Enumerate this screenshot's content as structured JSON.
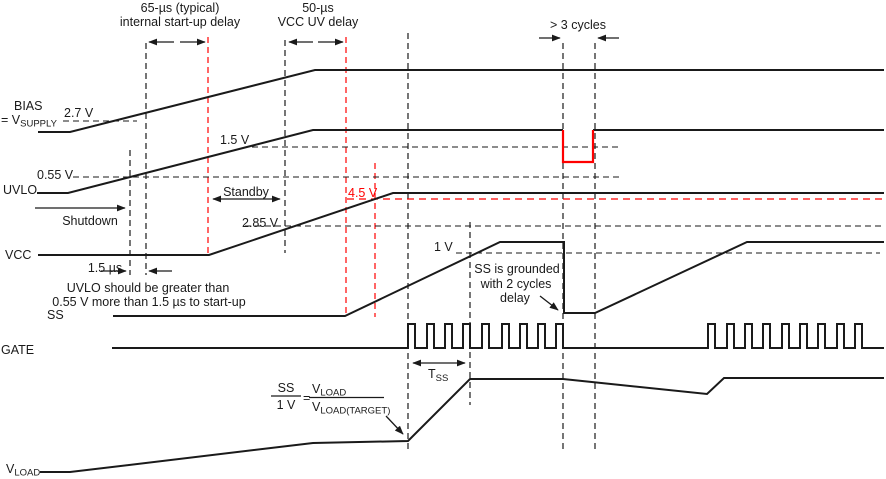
{
  "colors": {
    "line": "#1a1a1a",
    "highlight": "#ff0000",
    "background": "#ffffff"
  },
  "header": {
    "startup_delay": {
      "line1": "65-µs (typical)",
      "line2": "internal start-up delay"
    },
    "vcc_uv_delay": {
      "line1": "50-µs",
      "line2": "VCC UV delay"
    },
    "cycles": "> 3 cycles"
  },
  "signals": {
    "bias": {
      "label": "BIAS",
      "label2_main": "= V",
      "label2_sub": "SUPPLY",
      "threshold_2v7": "2.7 V"
    },
    "uvlo": {
      "label": "UVLO",
      "threshold_0v55": "0.55 V",
      "threshold_1v5": "1.5 V"
    },
    "vcc": {
      "label": "VCC",
      "threshold_2v85": "2.85 V",
      "threshold_4v5": "4.5 V"
    },
    "ss": {
      "label": "SS",
      "threshold_1v": "1 V"
    },
    "gate": {
      "label": "GATE"
    },
    "vload": {
      "label_main": "V",
      "label_sub": "LOAD"
    }
  },
  "annotations": {
    "shutdown": "Shutdown",
    "standby": "Standby",
    "delay_1us5": "1.5 µs",
    "uvlo_note": {
      "line1": "UVLO should be greater than",
      "line2": "0.55 V more than 1.5 µs to start-up"
    },
    "ss_grounded": {
      "line1": "SS is grounded",
      "line2": "with 2 cycles",
      "line3": "delay"
    },
    "tss": {
      "main": "T",
      "sub": "SS"
    }
  },
  "formula": {
    "lhs_num": "SS",
    "lhs_den": "1 V",
    "equals": "=",
    "rhs_num_main": "V",
    "rhs_num_sub": "LOAD",
    "rhs_den_main": "V",
    "rhs_den_sub": "LOAD(TARGET)"
  }
}
